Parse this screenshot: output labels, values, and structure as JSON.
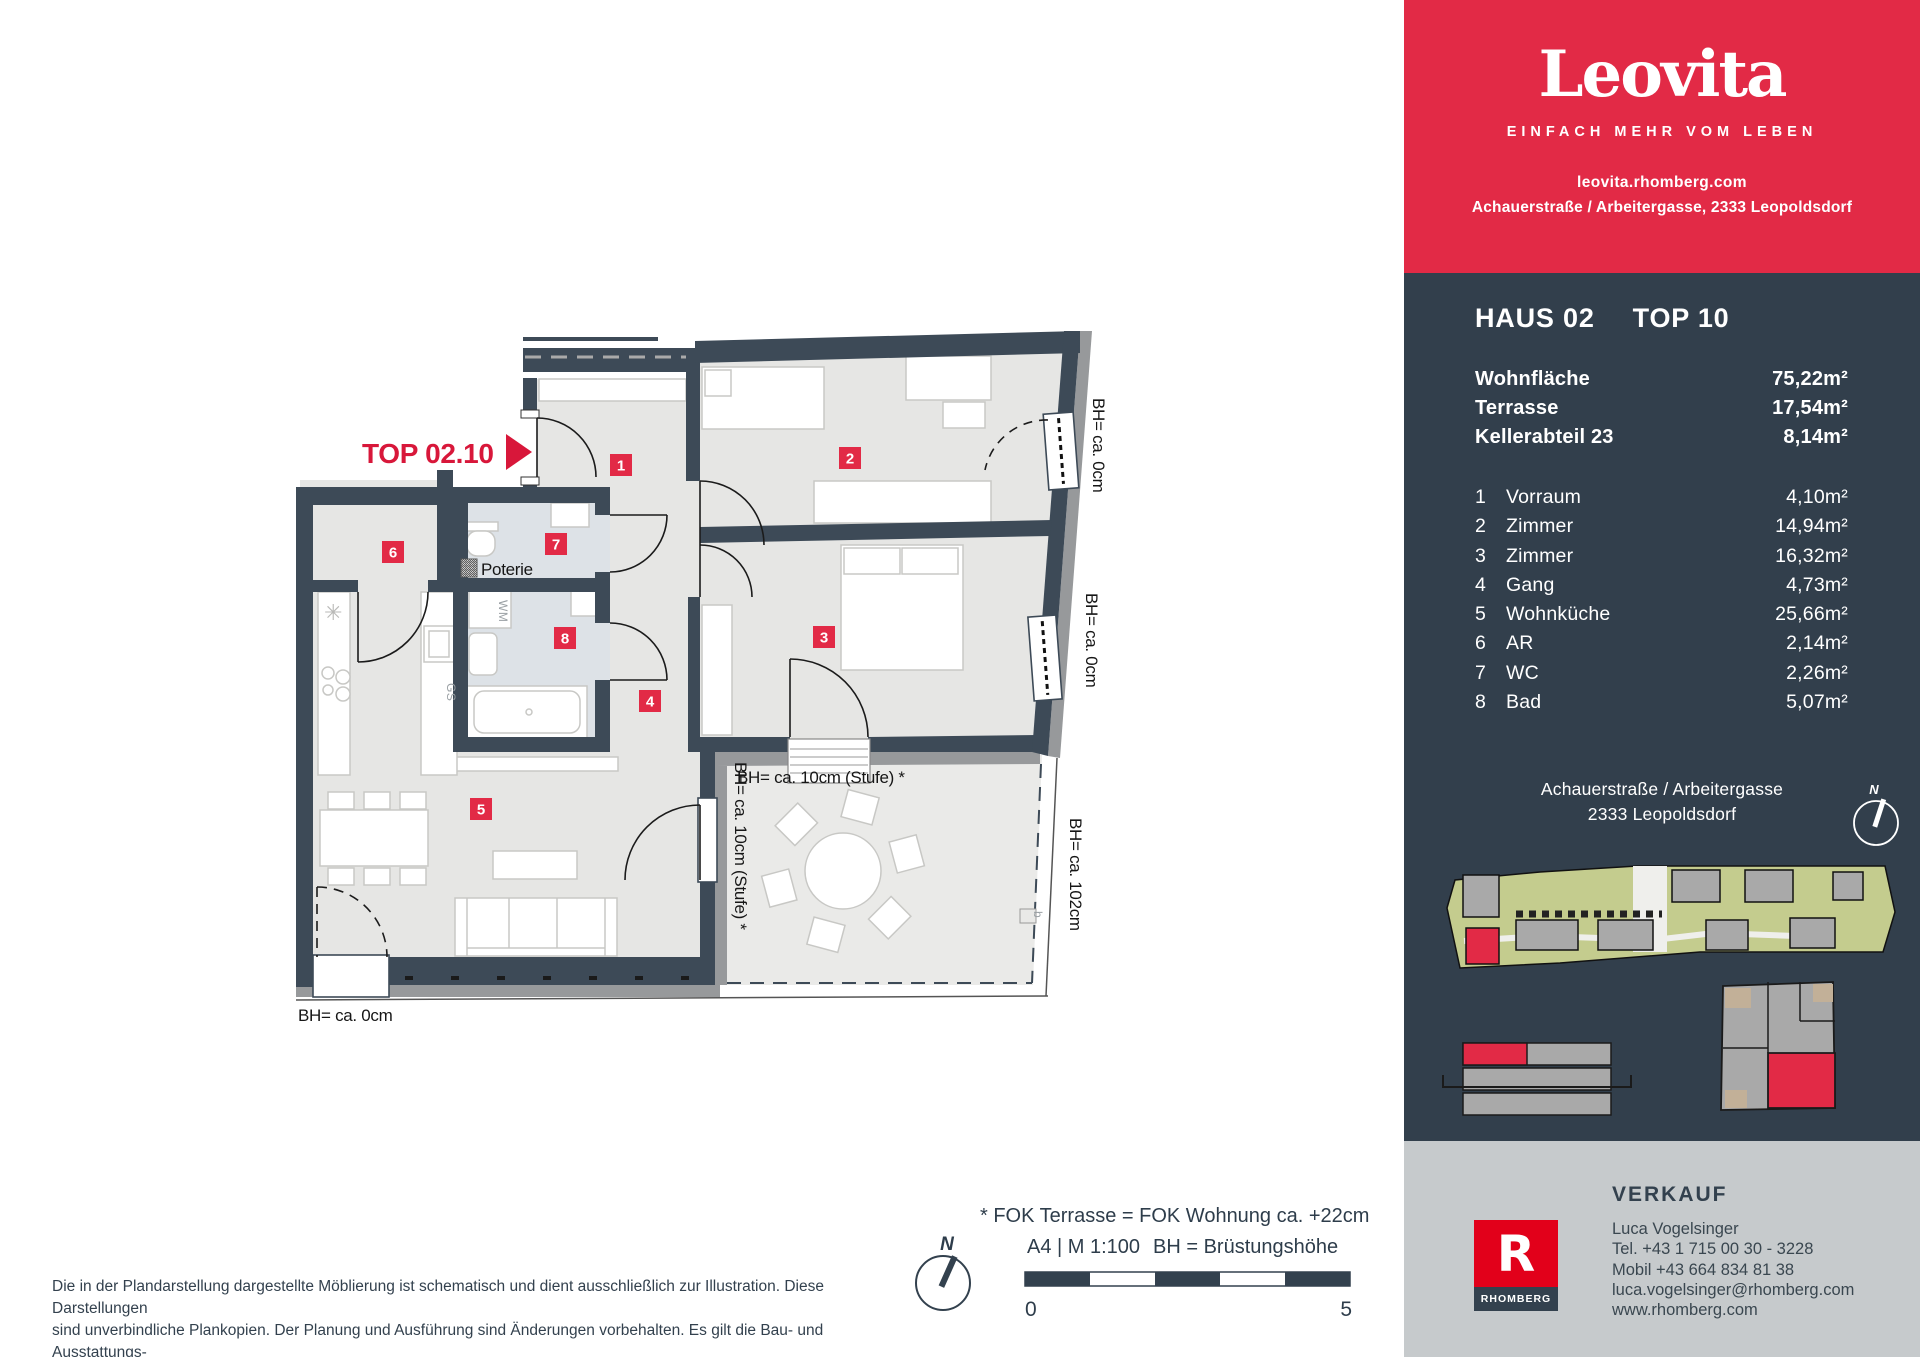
{
  "colors": {
    "brand_red": "#e22a46",
    "rhomberg_red": "#e2001a",
    "panel_navy": "#323f4c",
    "wall_navy": "#3d4a57",
    "room_fill": "#e6e6e4",
    "bath_fill": "#dde2e7",
    "terrace_fill": "#eaeae8",
    "siteplan_green": "#c4cc8e",
    "contact_gray": "#c6cacc"
  },
  "header": {
    "logo": "Leovita",
    "tagline": "EINFACH MEHR VOM LEBEN",
    "website": "leovita.rhomberg.com",
    "address": "Achauerstraße / Arbeitergasse, 2333 Leopoldsdorf"
  },
  "unit": {
    "haus": "HAUS 02",
    "top": "TOP 10",
    "areas": [
      {
        "label": "Wohnfläche",
        "value": "75,22m²"
      },
      {
        "label": "Terrasse",
        "value": "17,54m²"
      },
      {
        "label": "Kellerabteil 23",
        "value": "8,14m²"
      }
    ],
    "rooms": [
      {
        "nr": "1",
        "name": "Vorraum",
        "area": "4,10m²"
      },
      {
        "nr": "2",
        "name": "Zimmer",
        "area": "14,94m²"
      },
      {
        "nr": "3",
        "name": "Zimmer",
        "area": "16,32m²"
      },
      {
        "nr": "4",
        "name": "Gang",
        "area": "4,73m²"
      },
      {
        "nr": "5",
        "name": "Wohnküche",
        "area": "25,66m²"
      },
      {
        "nr": "6",
        "name": "AR",
        "area": "2,14m²"
      },
      {
        "nr": "7",
        "name": "WC",
        "area": "2,26m²"
      },
      {
        "nr": "8",
        "name": "Bad",
        "area": "5,07m²"
      }
    ]
  },
  "location": {
    "line1": "Achauerstraße / Arbeitergasse",
    "line2": "2333 Leopoldsdorf"
  },
  "plan": {
    "top_label": "TOP 02.10",
    "poterie": "Poterie",
    "bh0": "BH= ca. 0cm",
    "bh10": "BH= ca. 10cm (Stufe) *",
    "bh102": "BH= ca. 102cm",
    "wm": "WM",
    "gs": "GS",
    "b_marker": "b"
  },
  "footer": {
    "disclaimer": [
      "Die in der Plandarstellung dargestellte Möblierung ist schematisch und dient ausschließlich zur Illustration. Diese Darstellungen",
      "sind unverbindliche Plankopien. Der Planung und Ausführung sind Änderungen vorbehalten. Es gilt die Bau- und Ausstattungs-",
      "beschreibung. Sämtliche Maße sind Rohbaumaße."
    ],
    "planstand": "Planstand Februar 2023",
    "fok_note": "* FOK Terrasse = FOK Wohnung ca. +22cm",
    "format_scale": "A4 | M 1:100",
    "bh_legend": "BH = Brüstungshöhe",
    "scale_zero": "0",
    "scale_five": "5",
    "north": "N"
  },
  "verkauf": {
    "heading": "VERKAUF",
    "name": "Luca Vogelsinger",
    "tel": "Tel. +43 1 715 00 30 - 3228",
    "mobil": "Mobil +43 664 834 81 38",
    "email": "luca.vogelsinger@rhomberg.com",
    "web": "www.rhomberg.com",
    "logo_letter": "R",
    "logo_caption": "RHOMBERG"
  }
}
